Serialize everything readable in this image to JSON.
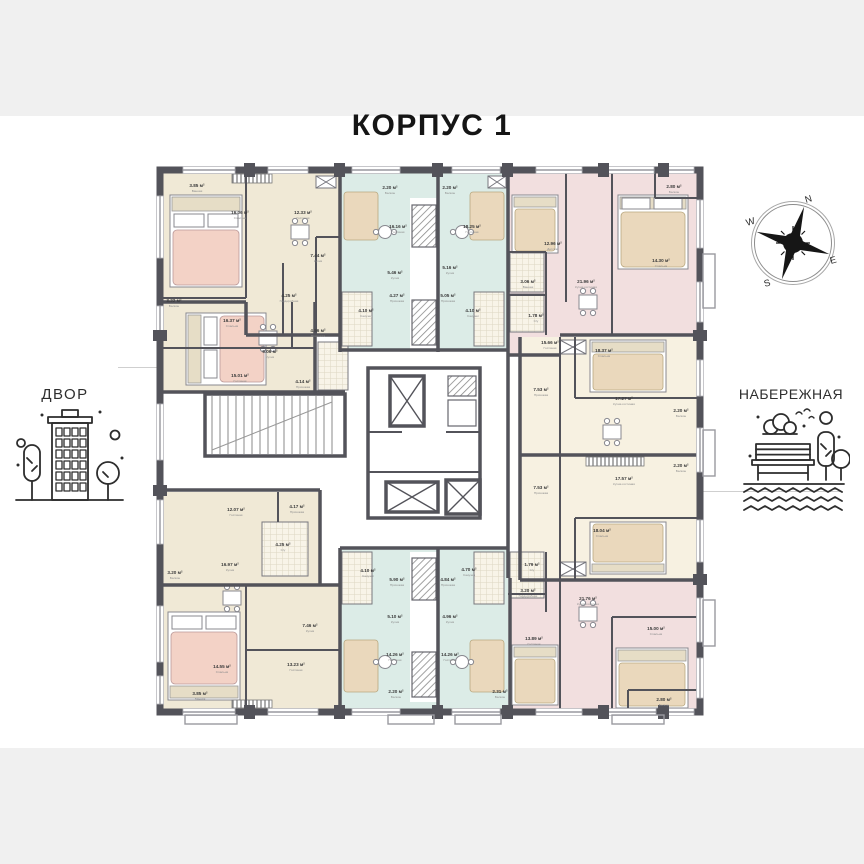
{
  "page": {
    "title": "КОРПУС 1"
  },
  "context_labels": {
    "left": "ДВОР",
    "right": "НАБЕРЕЖНАЯ"
  },
  "compass": {
    "n": "N",
    "e": "E",
    "s": "S",
    "w": "W"
  },
  "colors": {
    "wall": "#53535a",
    "beige": "#f0e9d6",
    "cream": "#f7f1e1",
    "mint": "#dcece7",
    "pink": "#f2dfdf",
    "bedpink": "#f3d2c6",
    "bedtan": "#ead8bc",
    "band": "#f0f0f0",
    "ink": "#151515"
  },
  "plan": {
    "rooms": [
      {
        "area": "3.85 м²",
        "name": "Ванная",
        "x": 197,
        "y": 187
      },
      {
        "area": "16.06 м²",
        "name": "Спальня",
        "x": 240,
        "y": 214
      },
      {
        "area": "12.33 м²",
        "name": "Гостиная",
        "x": 303,
        "y": 214
      },
      {
        "area": "7.44 м²",
        "name": "Кухня",
        "x": 318,
        "y": 257
      },
      {
        "area": "4.25 м²",
        "name": "Гардеробная",
        "x": 289,
        "y": 297
      },
      {
        "area": "3.22 м²",
        "name": "Балкон",
        "x": 174,
        "y": 302
      },
      {
        "area": "16.37 м²",
        "name": "Спальня",
        "x": 232,
        "y": 322
      },
      {
        "area": "4.56 м²",
        "name": "Прихожая",
        "x": 318,
        "y": 332
      },
      {
        "area": "5.06 м²",
        "name": "Кухня",
        "x": 270,
        "y": 353
      },
      {
        "area": "15.01 м²",
        "name": "Гостиная",
        "x": 240,
        "y": 377
      },
      {
        "area": "4.14 м²",
        "name": "Прихожая",
        "x": 303,
        "y": 383
      },
      {
        "area": "2.20 м²",
        "name": "Балкон",
        "x": 390,
        "y": 189
      },
      {
        "area": "16.16 м²",
        "name": "Гостиная",
        "x": 398,
        "y": 228
      },
      {
        "area": "5.46 м²",
        "name": "Кухня",
        "x": 395,
        "y": 274
      },
      {
        "area": "4.27 м²",
        "name": "Прихожая",
        "x": 397,
        "y": 297
      },
      {
        "area": "4.10 м²",
        "name": "Санузел",
        "x": 366,
        "y": 312
      },
      {
        "area": "2.20 м²",
        "name": "Балкон",
        "x": 450,
        "y": 189
      },
      {
        "area": "18.25 м²",
        "name": "Гостиная",
        "x": 472,
        "y": 228
      },
      {
        "area": "5.16 м²",
        "name": "Кухня",
        "x": 450,
        "y": 269
      },
      {
        "area": "5.05 м²",
        "name": "Прихожая",
        "x": 448,
        "y": 297
      },
      {
        "area": "4.10 м²",
        "name": "Санузел",
        "x": 473,
        "y": 312
      },
      {
        "area": "12.96 м²",
        "name": "Детская",
        "x": 553,
        "y": 245
      },
      {
        "area": "21.96 м²",
        "name": "Кухня-гостиная",
        "x": 586,
        "y": 283
      },
      {
        "area": "14.30 м²",
        "name": "Спальня",
        "x": 661,
        "y": 262
      },
      {
        "area": "2.80 м²",
        "name": "Балкон",
        "x": 674,
        "y": 188
      },
      {
        "area": "3.06 м²",
        "name": "Ванная",
        "x": 528,
        "y": 283
      },
      {
        "area": "1.78 м²",
        "name": "С/у",
        "x": 536,
        "y": 317
      },
      {
        "area": "15.66 м²",
        "name": "Гостиная",
        "x": 550,
        "y": 344
      },
      {
        "area": "18.37 м²",
        "name": "Спальня",
        "x": 604,
        "y": 352
      },
      {
        "area": "17.27 м²",
        "name": "Кухня-гостиная",
        "x": 624,
        "y": 400
      },
      {
        "area": "7.53 м²",
        "name": "Прихожая",
        "x": 541,
        "y": 391
      },
      {
        "area": "2.20 м²",
        "name": "Балкон",
        "x": 681,
        "y": 412
      },
      {
        "area": "7.53 м²",
        "name": "Прихожая",
        "x": 541,
        "y": 489
      },
      {
        "area": "17.57 м²",
        "name": "Кухня-гостиная",
        "x": 624,
        "y": 480
      },
      {
        "area": "18.04 м²",
        "name": "Спальня",
        "x": 602,
        "y": 532
      },
      {
        "area": "2.20 м²",
        "name": "Балкон",
        "x": 681,
        "y": 467
      },
      {
        "area": "13.89 м²",
        "name": "Гостиная",
        "x": 534,
        "y": 640
      },
      {
        "area": "21.76 м²",
        "name": "Кухня-гостиная",
        "x": 588,
        "y": 600
      },
      {
        "area": "15.00 м²",
        "name": "Спальня",
        "x": 656,
        "y": 630
      },
      {
        "area": "2.80 м²",
        "name": "Балкон",
        "x": 664,
        "y": 701
      },
      {
        "area": "1.79 м²",
        "name": "С/у",
        "x": 532,
        "y": 566
      },
      {
        "area": "3.20 м²",
        "name": "Гардеробная",
        "x": 528,
        "y": 592
      },
      {
        "area": "5.90 м²",
        "name": "Прихожая",
        "x": 397,
        "y": 581
      },
      {
        "area": "5.10 м²",
        "name": "Кухня",
        "x": 395,
        "y": 618
      },
      {
        "area": "14.26 м²",
        "name": "Гостиная",
        "x": 395,
        "y": 656
      },
      {
        "area": "4.10 м²",
        "name": "Санузел",
        "x": 368,
        "y": 572
      },
      {
        "area": "2.20 м²",
        "name": "Балкон",
        "x": 396,
        "y": 693
      },
      {
        "area": "4.84 м²",
        "name": "Прихожая",
        "x": 448,
        "y": 581
      },
      {
        "area": "4.96 м²",
        "name": "Кухня",
        "x": 450,
        "y": 618
      },
      {
        "area": "14.26 м²",
        "name": "Гостиная",
        "x": 450,
        "y": 656
      },
      {
        "area": "4.70 м²",
        "name": "Санузел",
        "x": 469,
        "y": 571
      },
      {
        "area": "2.31 м²",
        "name": "Балкон",
        "x": 500,
        "y": 693
      },
      {
        "area": "12.07 м²",
        "name": "Гостиная",
        "x": 236,
        "y": 511
      },
      {
        "area": "4.17 м²",
        "name": "Прихожая",
        "x": 297,
        "y": 508
      },
      {
        "area": "16.97 м²",
        "name": "Кухня",
        "x": 230,
        "y": 566
      },
      {
        "area": "3.20 м²",
        "name": "Балкон",
        "x": 175,
        "y": 574
      },
      {
        "area": "4.25 м²",
        "name": "С/у",
        "x": 283,
        "y": 546
      },
      {
        "area": "7.46 м²",
        "name": "Кухня",
        "x": 310,
        "y": 627
      },
      {
        "area": "14.55 м²",
        "name": "Спальня",
        "x": 222,
        "y": 668
      },
      {
        "area": "13.23 м²",
        "name": "Гостиная",
        "x": 296,
        "y": 666
      },
      {
        "area": "3.85 м²",
        "name": "Ванная",
        "x": 200,
        "y": 695
      }
    ]
  }
}
